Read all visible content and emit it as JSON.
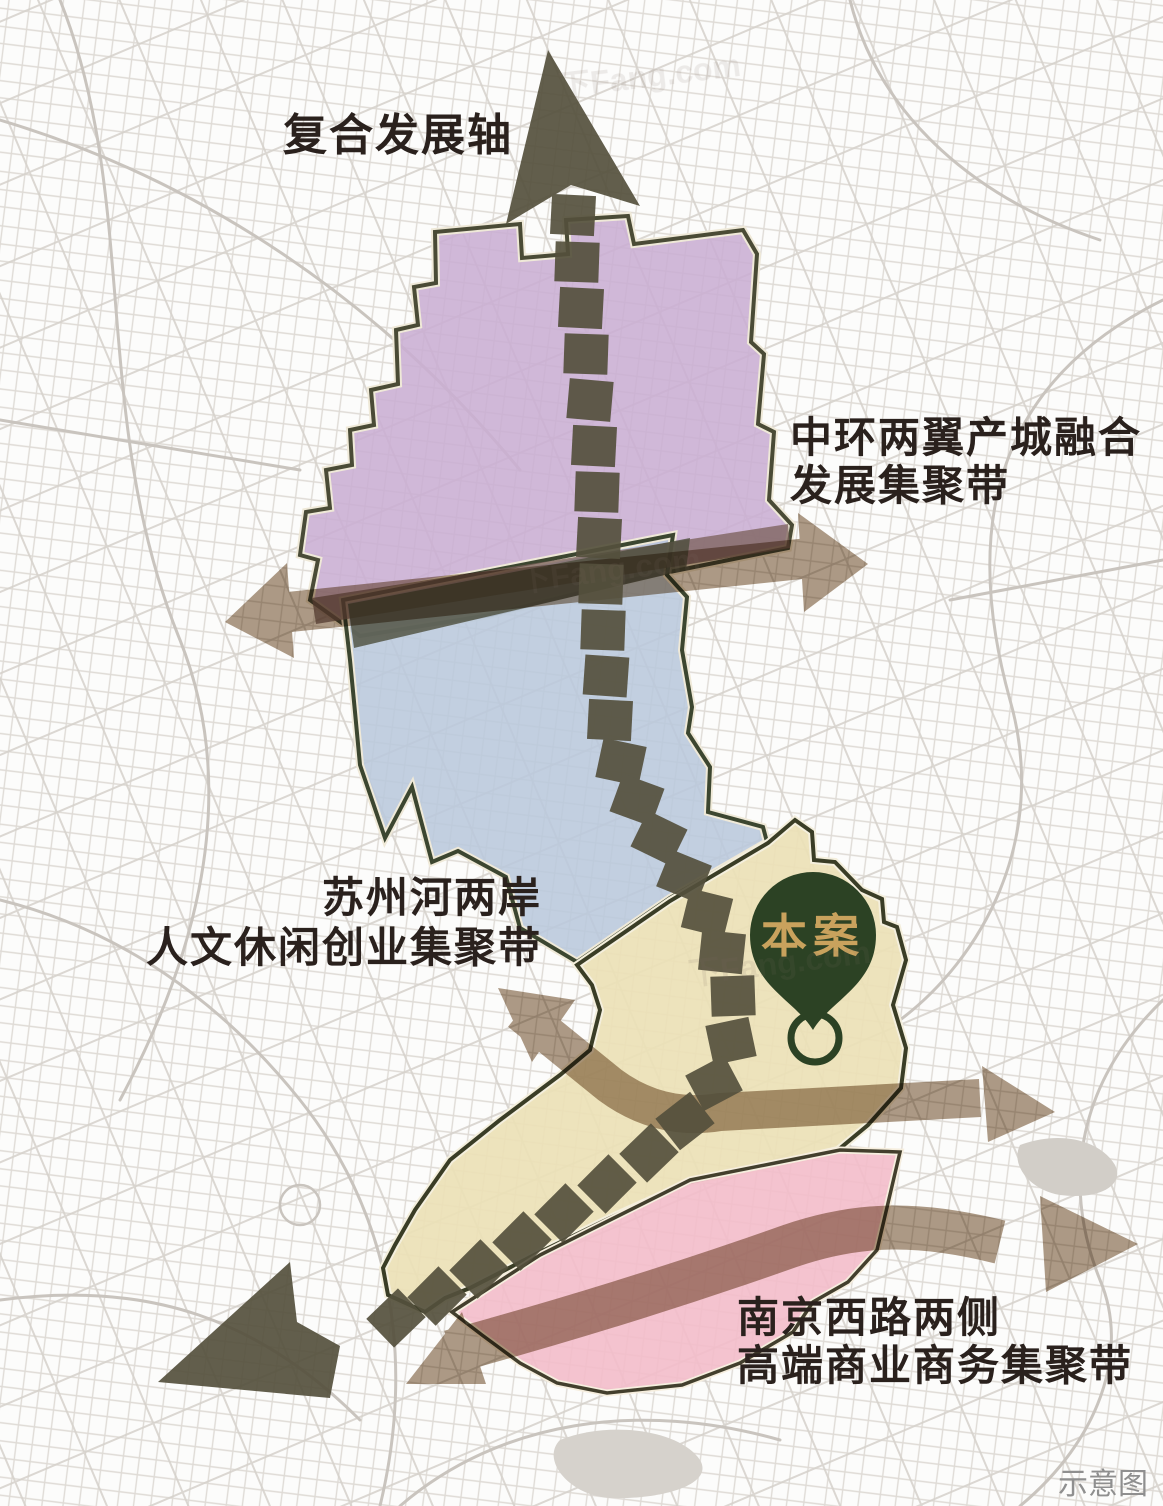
{
  "labels": {
    "axis": "复合发展轴",
    "east_belt": {
      "line1": "中环两翼产城融合",
      "line2": "发展集聚带"
    },
    "west_belt": {
      "line1": "苏州河两岸",
      "line2": "人文休闲创业集聚带"
    },
    "south_belt": {
      "line1": "南京西路两侧",
      "line2": "高端商业商务集聚带"
    },
    "site_pin": "本案",
    "caption": "示意图",
    "watermark": "下Fang.com"
  },
  "colors": {
    "zone_north_purple": "#c9aed3",
    "zone_central_blue": "#b9c8dc",
    "zone_site_cream": "#ece1b6",
    "zone_south_pink": "#f3bcca",
    "axis_dark_olive": "#54503d",
    "belt_arrow_tan": "#9b8268",
    "pin_green": "#2c4224",
    "pin_gold_text": "#c9a25d",
    "label_text": "#2a211d",
    "caption_text": "#8f8f8f",
    "street_line": "#d5d1cb"
  }
}
